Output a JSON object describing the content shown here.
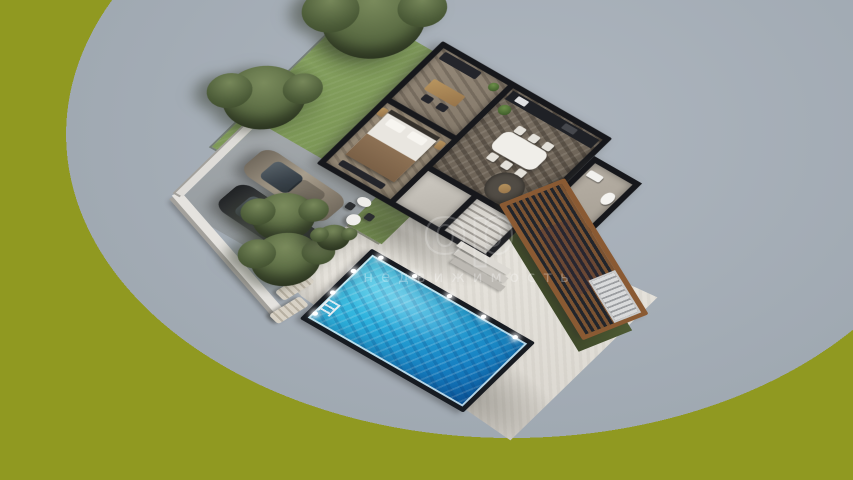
{
  "watermark": {
    "logo_text": "ор",
    "caption": "недвижимость"
  },
  "palette": {
    "background_center": "#aeb6bf",
    "background_edge": "#8e969f",
    "lawn": "#7d9857",
    "terrace_stone": "#e8e5df",
    "pool_water_light": "#5ad8ee",
    "pool_water_dark": "#0d5ea6",
    "pool_coping": "#171b21",
    "house_walls": "#16171b",
    "interior_floor": "#7a7063",
    "deck_wood_frame": "#8a5a33",
    "deck_slat_dark": "#22252b",
    "car_bronze": "#a89e8d",
    "car_dark": "#2a2c2f",
    "tree_foliage": "#55663f",
    "driveway": "#9aa0a4"
  },
  "scene_objects": [
    "lawn",
    "garden-trees",
    "driveway",
    "parked-cars",
    "boundary-wall",
    "house",
    "office-room",
    "bedroom",
    "living-dining-room",
    "kitchen-counter",
    "bathroom",
    "staircase",
    "entry-steps",
    "stone-terrace",
    "swimming-pool",
    "pool-lights",
    "pool-ladder",
    "sun-loungers",
    "bistro-set",
    "pergola-deck"
  ]
}
